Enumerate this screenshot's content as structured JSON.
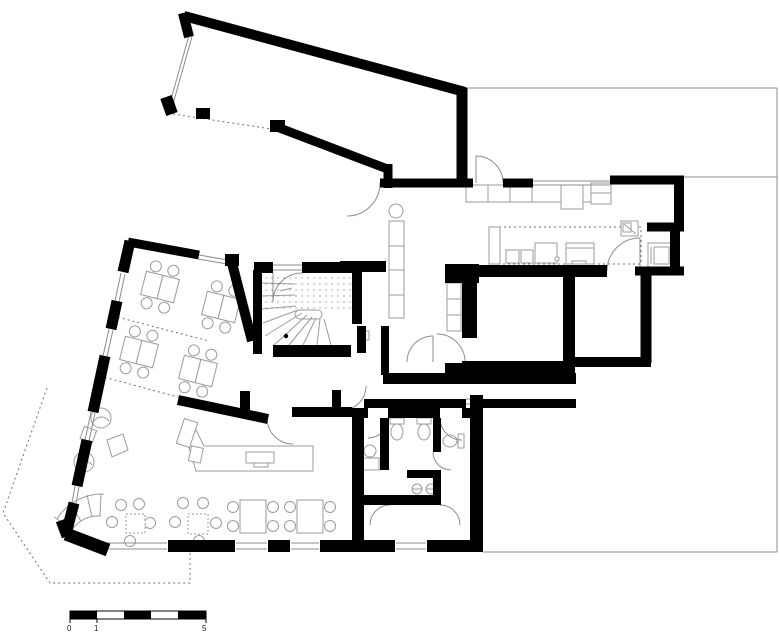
{
  "document": {
    "kind": "architectural floor plan",
    "level": "ground floor"
  },
  "scale_bar": {
    "label_start": "0",
    "label_mid": "1",
    "label_end": "5"
  },
  "colors": {
    "walls": "#000000",
    "thin_lines": "#8d8d8d",
    "furniture_lines": "#9b9b9b",
    "dotted_lines": "#6f6f6f",
    "background": "#ffffff"
  },
  "elements": {
    "rooms": [
      "large-hall-top",
      "office-room-1",
      "office-room-2",
      "stair-room",
      "kitchen",
      "utility-room",
      "pantry",
      "middle-room",
      "corridor",
      "wc-block",
      "restaurant-lounge",
      "cafe-seating"
    ],
    "symbols": [
      "winder-stair-icon",
      "door-arc-icon",
      "desk-and-chairs-icon",
      "cafe-table-icon",
      "lounge-chair-icon",
      "bar-counter-icon",
      "kitchen-island-icon",
      "toilet-icon",
      "sink-icon",
      "scale-bar"
    ]
  }
}
